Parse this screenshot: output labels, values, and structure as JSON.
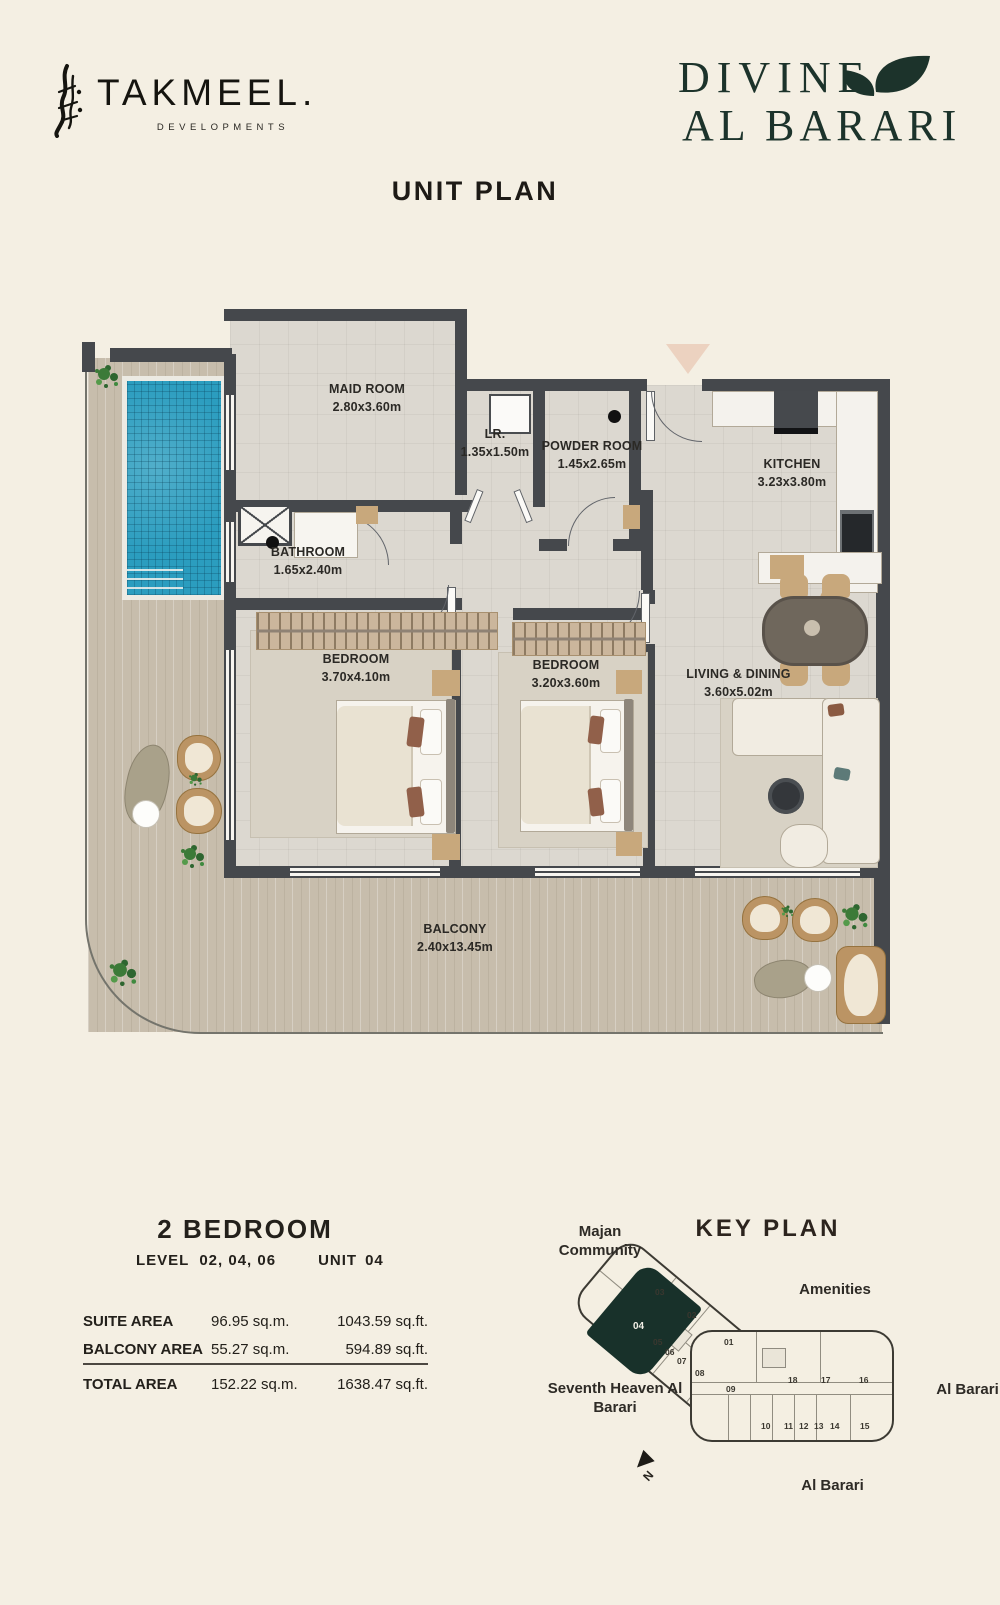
{
  "header": {
    "takmeel_name": "TAKMEEL.",
    "takmeel_tagline": "DEVELOPMENTS",
    "divine_line1": "DIVINE",
    "divine_line2": "AL BARARI"
  },
  "page_title": "UNIT PLAN",
  "colors": {
    "background": "#f4efe3",
    "divine_green": "#1c332b",
    "wall_gray": "#45484c",
    "pool_blue": "#2b9dbf",
    "keyplan_highlight": "#18312a"
  },
  "plan": {
    "rooms": [
      {
        "name": "MAID ROOM",
        "dim": "2.80x3.60m"
      },
      {
        "name": "LR.",
        "dim": "1.35x1.50m"
      },
      {
        "name": "POWDER ROOM",
        "dim": "1.45x2.65m"
      },
      {
        "name": "KITCHEN",
        "dim": "3.23x3.80m"
      },
      {
        "name": "BATHROOM",
        "dim": "1.65x2.40m"
      },
      {
        "name": "BEDROOM",
        "dim": "3.70x4.10m"
      },
      {
        "name": "BEDROOM",
        "dim": "3.20x3.60m"
      },
      {
        "name": "LIVING & DINING",
        "dim": "3.60x5.02m"
      },
      {
        "name": "BALCONY",
        "dim": "2.40x13.45m"
      }
    ]
  },
  "unit_info": {
    "type": "2 BEDROOM",
    "level_label": "LEVEL",
    "levels": "02, 04, 06",
    "unit_label": "UNIT",
    "unit_number": "04",
    "areas": [
      {
        "label": "SUITE AREA",
        "sqm": "96.95 sq.m.",
        "sqft": "1043.59 sq.ft."
      },
      {
        "label": "BALCONY AREA",
        "sqm": "55.27 sq.m.",
        "sqft": "594.89 sq.ft."
      },
      {
        "label": "TOTAL AREA",
        "sqm": "152.22 sq.m.",
        "sqft": "1638.47 sq.ft."
      }
    ]
  },
  "keyplan": {
    "title": "KEY PLAN",
    "labels": {
      "majan": "Majan Community",
      "amenities": "Amenities",
      "seventh_heaven": "Seventh Heaven Al Barari",
      "al_barari_right": "Al Barari",
      "al_barari_bottom": "Al Barari",
      "north": "N"
    },
    "highlighted_unit": "04",
    "units": [
      "03",
      "02",
      "01",
      "04",
      "05",
      "06",
      "07",
      "08",
      "09",
      "18",
      "17",
      "16",
      "10",
      "11",
      "12",
      "13",
      "14",
      "15"
    ]
  }
}
